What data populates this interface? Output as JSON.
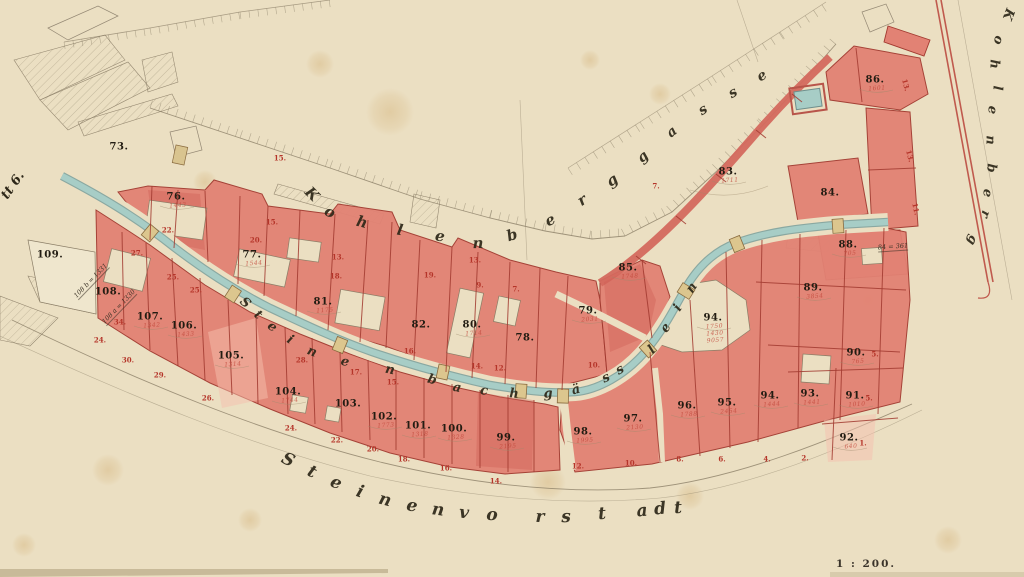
{
  "edge_label": "tt 6.",
  "scale_label": "1 : 200.",
  "streets": {
    "kohlenberg_top": "Kohlenberg",
    "gasse": "gasse",
    "kohlenberg_right": "Kohlenberg",
    "gaesslein": "Steinenbachgässlein",
    "vorstadt": "Steinenvorstadt"
  },
  "colors": {
    "paper": "#ebdfc2",
    "parcel_red": "#e28274",
    "parcel_red_light": "#f5c0ae",
    "parcel_red_deep": "#cf6054",
    "parcel_line": "#a23a30",
    "carmine_text": "#b5352a",
    "ink_text": "#221c12",
    "stream_fill": "#a7cdc6",
    "stream_edge": "#7fa29d",
    "bridge": "#dcc68e",
    "pencil": "#8c7f68"
  },
  "parcel_numbers": [
    {
      "n": "73.",
      "x": 119,
      "y": 147
    },
    {
      "n": "76.",
      "x": 176,
      "y": 197,
      "sub": "1443"
    },
    {
      "n": "77.",
      "x": 252,
      "y": 255,
      "sub": "1544"
    },
    {
      "n": "81.",
      "x": 323,
      "y": 302,
      "sub": "1175"
    },
    {
      "n": "82.",
      "x": 421,
      "y": 325
    },
    {
      "n": "80.",
      "x": 472,
      "y": 325,
      "sub": "1714"
    },
    {
      "n": "78.",
      "x": 525,
      "y": 338
    },
    {
      "n": "79.",
      "x": 588,
      "y": 311,
      "sub": "2031"
    },
    {
      "n": "85.",
      "x": 628,
      "y": 268,
      "sub": "1748"
    },
    {
      "n": "83.",
      "x": 728,
      "y": 172,
      "sub": "1711"
    },
    {
      "n": "86.",
      "x": 875,
      "y": 80,
      "sub": "1601"
    },
    {
      "n": "84.",
      "x": 830,
      "y": 193
    },
    {
      "n": "88.",
      "x": 848,
      "y": 245,
      "sub": "705"
    },
    {
      "n": "89.",
      "x": 813,
      "y": 288,
      "sub": "3854"
    },
    {
      "n": "94.",
      "x": 713,
      "y": 318,
      "sub": "1750\n1430\n9057"
    },
    {
      "n": "109.",
      "x": 50,
      "y": 255
    },
    {
      "n": "108.",
      "x": 108,
      "y": 292
    },
    {
      "n": "107.",
      "x": 150,
      "y": 317,
      "sub": "1342"
    },
    {
      "n": "106.",
      "x": 184,
      "y": 326,
      "sub": "1433"
    },
    {
      "n": "105.",
      "x": 231,
      "y": 356,
      "sub": "1314"
    },
    {
      "n": "104.",
      "x": 288,
      "y": 392,
      "sub": "1744"
    },
    {
      "n": "103.",
      "x": 348,
      "y": 404
    },
    {
      "n": "102.",
      "x": 384,
      "y": 417,
      "sub": "1773"
    },
    {
      "n": "101.",
      "x": 418,
      "y": 426,
      "sub": "1318"
    },
    {
      "n": "100.",
      "x": 454,
      "y": 429,
      "sub": "1328"
    },
    {
      "n": "99.",
      "x": 506,
      "y": 438,
      "sub": "2195"
    },
    {
      "n": "98.",
      "x": 583,
      "y": 432,
      "sub": "1995"
    },
    {
      "n": "97.",
      "x": 633,
      "y": 419,
      "sub": "2130"
    },
    {
      "n": "96.",
      "x": 687,
      "y": 406,
      "sub": "1788"
    },
    {
      "n": "95.",
      "x": 727,
      "y": 403,
      "sub": "2454"
    },
    {
      "n": "94.",
      "x": 770,
      "y": 396,
      "sub": "1444"
    },
    {
      "n": "93.",
      "x": 810,
      "y": 394,
      "sub": "1441"
    },
    {
      "n": "91.",
      "x": 855,
      "y": 396,
      "sub": "1010"
    },
    {
      "n": "92.",
      "x": 849,
      "y": 438,
      "sub": "640"
    },
    {
      "n": "90.",
      "x": 856,
      "y": 353,
      "sub": "765"
    }
  ],
  "house_numbers": [
    {
      "n": "15.",
      "x": 272,
      "y": 222
    },
    {
      "n": "20.",
      "x": 256,
      "y": 240
    },
    {
      "n": "22.",
      "x": 168,
      "y": 230
    },
    {
      "n": "25.",
      "x": 196,
      "y": 290
    },
    {
      "n": "27.",
      "x": 137,
      "y": 253
    },
    {
      "n": "25.",
      "x": 173,
      "y": 277
    },
    {
      "n": "34.",
      "x": 120,
      "y": 322
    },
    {
      "n": "30.",
      "x": 128,
      "y": 360
    },
    {
      "n": "29.",
      "x": 160,
      "y": 375
    },
    {
      "n": "26.",
      "x": 208,
      "y": 398
    },
    {
      "n": "24.",
      "x": 100,
      "y": 340
    },
    {
      "n": "13.",
      "x": 338,
      "y": 257
    },
    {
      "n": "18.",
      "x": 336,
      "y": 276
    },
    {
      "n": "19.",
      "x": 430,
      "y": 275
    },
    {
      "n": "9.",
      "x": 480,
      "y": 285
    },
    {
      "n": "7.",
      "x": 516,
      "y": 289
    },
    {
      "n": "16.",
      "x": 410,
      "y": 351
    },
    {
      "n": "28.",
      "x": 302,
      "y": 360
    },
    {
      "n": "17.",
      "x": 356,
      "y": 372
    },
    {
      "n": "15.",
      "x": 393,
      "y": 382
    },
    {
      "n": "14.",
      "x": 477,
      "y": 366
    },
    {
      "n": "12.",
      "x": 500,
      "y": 368
    },
    {
      "n": "10.",
      "x": 594,
      "y": 365
    },
    {
      "n": "24.",
      "x": 291,
      "y": 428
    },
    {
      "n": "22.",
      "x": 337,
      "y": 440
    },
    {
      "n": "20.",
      "x": 373,
      "y": 449
    },
    {
      "n": "18.",
      "x": 404,
      "y": 459
    },
    {
      "n": "16.",
      "x": 446,
      "y": 468
    },
    {
      "n": "14.",
      "x": 496,
      "y": 481
    },
    {
      "n": "12.",
      "x": 578,
      "y": 466
    },
    {
      "n": "10.",
      "x": 631,
      "y": 463
    },
    {
      "n": "8.",
      "x": 680,
      "y": 459
    },
    {
      "n": "6.",
      "x": 722,
      "y": 459
    },
    {
      "n": "4.",
      "x": 767,
      "y": 459
    },
    {
      "n": "2.",
      "x": 805,
      "y": 458
    },
    {
      "n": "5.",
      "x": 875,
      "y": 354
    },
    {
      "n": "5.",
      "x": 869,
      "y": 398
    },
    {
      "n": "1.",
      "x": 863,
      "y": 443
    },
    {
      "n": "11.",
      "x": 916,
      "y": 209,
      "rot": 78
    },
    {
      "n": "13.",
      "x": 906,
      "y": 85,
      "rot": 75
    },
    {
      "n": "13.",
      "x": 910,
      "y": 156,
      "rot": 75
    },
    {
      "n": "7.",
      "x": 656,
      "y": 186
    },
    {
      "n": "15.",
      "x": 280,
      "y": 158
    },
    {
      "n": "13.",
      "x": 475,
      "y": 260
    }
  ],
  "annotations": [
    {
      "text": "108 b = 1331",
      "x": 91,
      "y": 281,
      "rot": -46
    },
    {
      "text": "108 a = 1330",
      "x": 119,
      "y": 307,
      "rot": -46
    },
    {
      "text": "84 = 361",
      "x": 893,
      "y": 247,
      "rot": -4
    }
  ]
}
